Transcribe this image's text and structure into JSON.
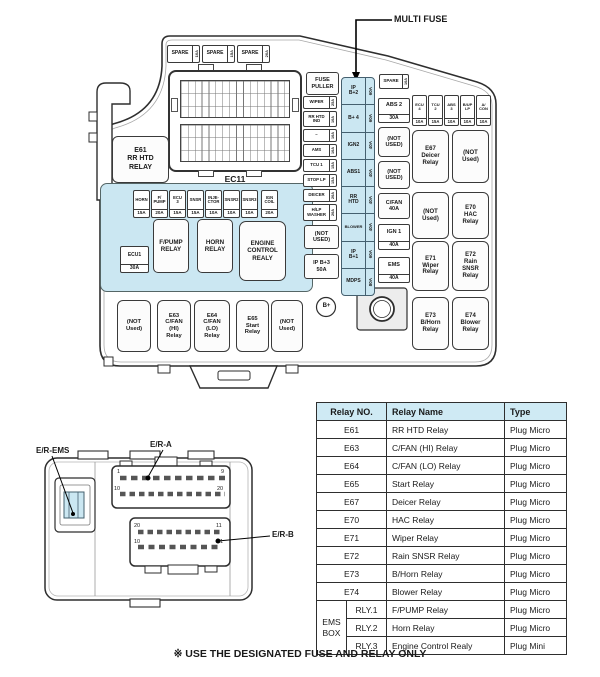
{
  "colors": {
    "highlight": "#cbe7f2",
    "table_header_bg": "#cfeaf4",
    "line": "#333333"
  },
  "callout": {
    "multi_fuse_label": "MULTI FUSE"
  },
  "fuse_box": {
    "spare_fuses_top": [
      {
        "name": "SPARE",
        "amp": "10A"
      },
      {
        "name": "SPARE",
        "amp": "15A"
      },
      {
        "name": "SPARE",
        "amp": "20A"
      }
    ],
    "ec11_label": "EC11",
    "e61_relay": "E61\nRR HTD\nRELAY",
    "ems_region": {
      "fuse_row": [
        {
          "name": "HORN",
          "amp": "15A"
        },
        {
          "name": "F/\nPUMP",
          "amp": "20A"
        },
        {
          "name": "ECU\n3",
          "amp": "15A"
        },
        {
          "name": "SNSR",
          "amp": "15A"
        },
        {
          "name": "INJE-\nCTOR",
          "amp": "10A"
        },
        {
          "name": "SNSR2",
          "amp": "10A"
        },
        {
          "name": "SNSR3",
          "amp": "10A"
        },
        {
          "name": "IGN\nCOIL",
          "amp": "20A"
        }
      ],
      "ecu1_fuse": {
        "name": "ECU1",
        "amp": "30A"
      },
      "fpump_relay": "F/PUMP\nRELAY",
      "horn_relay": "HORN\nRELAY",
      "engine_control_relay": "ENGINE\nCONTROL\nREALY"
    },
    "bottom_relay_row": [
      "(NOT\nUsed)",
      "E63\nC/FAN\n(HI)\nRelay",
      "E64\nC/FAN\n(LO)\nRelay",
      "E65\nStart\nRelay",
      "(NOT\nUsed)"
    ],
    "fuse_puller": "FUSE\nPULLER",
    "left_fuse_column": [
      {
        "name": "WIPER",
        "amp": "25A"
      },
      {
        "name": "RR HTD\nIND",
        "amp": "10A"
      },
      {
        "name": "–",
        "amp": "10A"
      },
      {
        "name": "AMS",
        "amp": "10A"
      },
      {
        "name": "TCU 1",
        "amp": "15A"
      },
      {
        "name": "STOP LP",
        "amp": "15A"
      },
      {
        "name": "DEICER",
        "amp": "20A"
      },
      {
        "name": "H/LP\nWASHER",
        "amp": "20A"
      }
    ],
    "not_used_left": "(NOT\nUSED)",
    "ip_b3_fuse": "IP B+3\n50A",
    "multi_fuse_strip": [
      {
        "name": "IP\nB+2",
        "amp": "60A"
      },
      {
        "name": "B+ 4",
        "amp": "60A"
      },
      {
        "name": "IGN2",
        "amp": "40A"
      },
      {
        "name": "ABS1",
        "amp": "40A"
      },
      {
        "name": "RR\nHTD",
        "amp": "40A"
      },
      {
        "name": "BLOWER",
        "amp": "40A"
      },
      {
        "name": "IP\nB+1",
        "amp": "60A"
      },
      {
        "name": "MDPS",
        "amp": "80A"
      }
    ],
    "mid_column": {
      "spare": {
        "name": "SPARE",
        "amp": "10A"
      },
      "abs2": {
        "name": "ABS 2",
        "amp": "30A"
      },
      "not_used_1": "(NOT\nUSED)",
      "not_used_2": "(NOT\nUSED)",
      "cfan": "C/FAN\n40A",
      "ign1": {
        "name": "IGN 1",
        "amp": "40A"
      },
      "ems": {
        "name": "EMS",
        "amp": "40A"
      }
    },
    "small_fuse_row": [
      {
        "name": "ECU\n4",
        "amp": "10A"
      },
      {
        "name": "TCU\n2",
        "amp": "15A"
      },
      {
        "name": "ABS\n3",
        "amp": "10A"
      },
      {
        "name": "B/UP\nLP",
        "amp": "10A"
      },
      {
        "name": "A/\nCON",
        "amp": "10A"
      }
    ],
    "relay_grid": [
      "E67\nDeicer\nRelay",
      "(NOT\nUsed)",
      "(NOT\nUsed)",
      "E70\nHAC\nRelay",
      "E71\nWiper\nRelay",
      "E72\nRain\nSNSR\nRelay",
      "E73\nB/Horn\nRelay",
      "E74\nBlower\nRelay"
    ],
    "b_plus_terminal": "B+"
  },
  "connector_view": {
    "er_ems_label": "E/R-EMS",
    "er_a_label": "E/R-A",
    "er_b_label": "E/R-B",
    "a_pins": {
      "top_left": "1",
      "top_right": "9",
      "bottom_left": "10",
      "bottom_right": "20"
    },
    "b_pins": {
      "top_left": "20",
      "top_right": "11",
      "bottom_left": "10",
      "bottom_right": "1"
    }
  },
  "relay_table": {
    "headers": {
      "no": "Relay NO.",
      "name": "Relay Name",
      "type": "Type"
    },
    "rows": [
      {
        "no": "E61",
        "name": "RR HTD Relay",
        "type": "Plug Micro"
      },
      {
        "no": "E63",
        "name": "C/FAN (HI) Relay",
        "type": "Plug Micro"
      },
      {
        "no": "E64",
        "name": "C/FAN (LO) Relay",
        "type": "Plug Micro"
      },
      {
        "no": "E65",
        "name": "Start Relay",
        "type": "Plug Micro"
      },
      {
        "no": "E67",
        "name": "Deicer Relay",
        "type": "Plug Micro"
      },
      {
        "no": "E70",
        "name": "HAC Relay",
        "type": "Plug Micro"
      },
      {
        "no": "E71",
        "name": "Wiper Relay",
        "type": "Plug Micro"
      },
      {
        "no": "E72",
        "name": "Rain SNSR Relay",
        "type": "Plug Micro"
      },
      {
        "no": "E73",
        "name": "B/Horn Relay",
        "type": "Plug Micro"
      },
      {
        "no": "E74",
        "name": "Blower Relay",
        "type": "Plug Micro"
      }
    ],
    "ems_box_group": {
      "label": "EMS\nBOX",
      "rows": [
        {
          "no": "RLY.1",
          "name": "F/PUMP Relay",
          "type": "Plug Micro"
        },
        {
          "no": "RLY.2",
          "name": "Horn Relay",
          "type": "Plug Micro"
        },
        {
          "no": "RLY.3",
          "name": "Engine Control Realy",
          "type": "Plug Mini"
        }
      ]
    }
  },
  "footer_note": "※ USE THE DESIGNATED FUSE AND RELAY ONLY"
}
